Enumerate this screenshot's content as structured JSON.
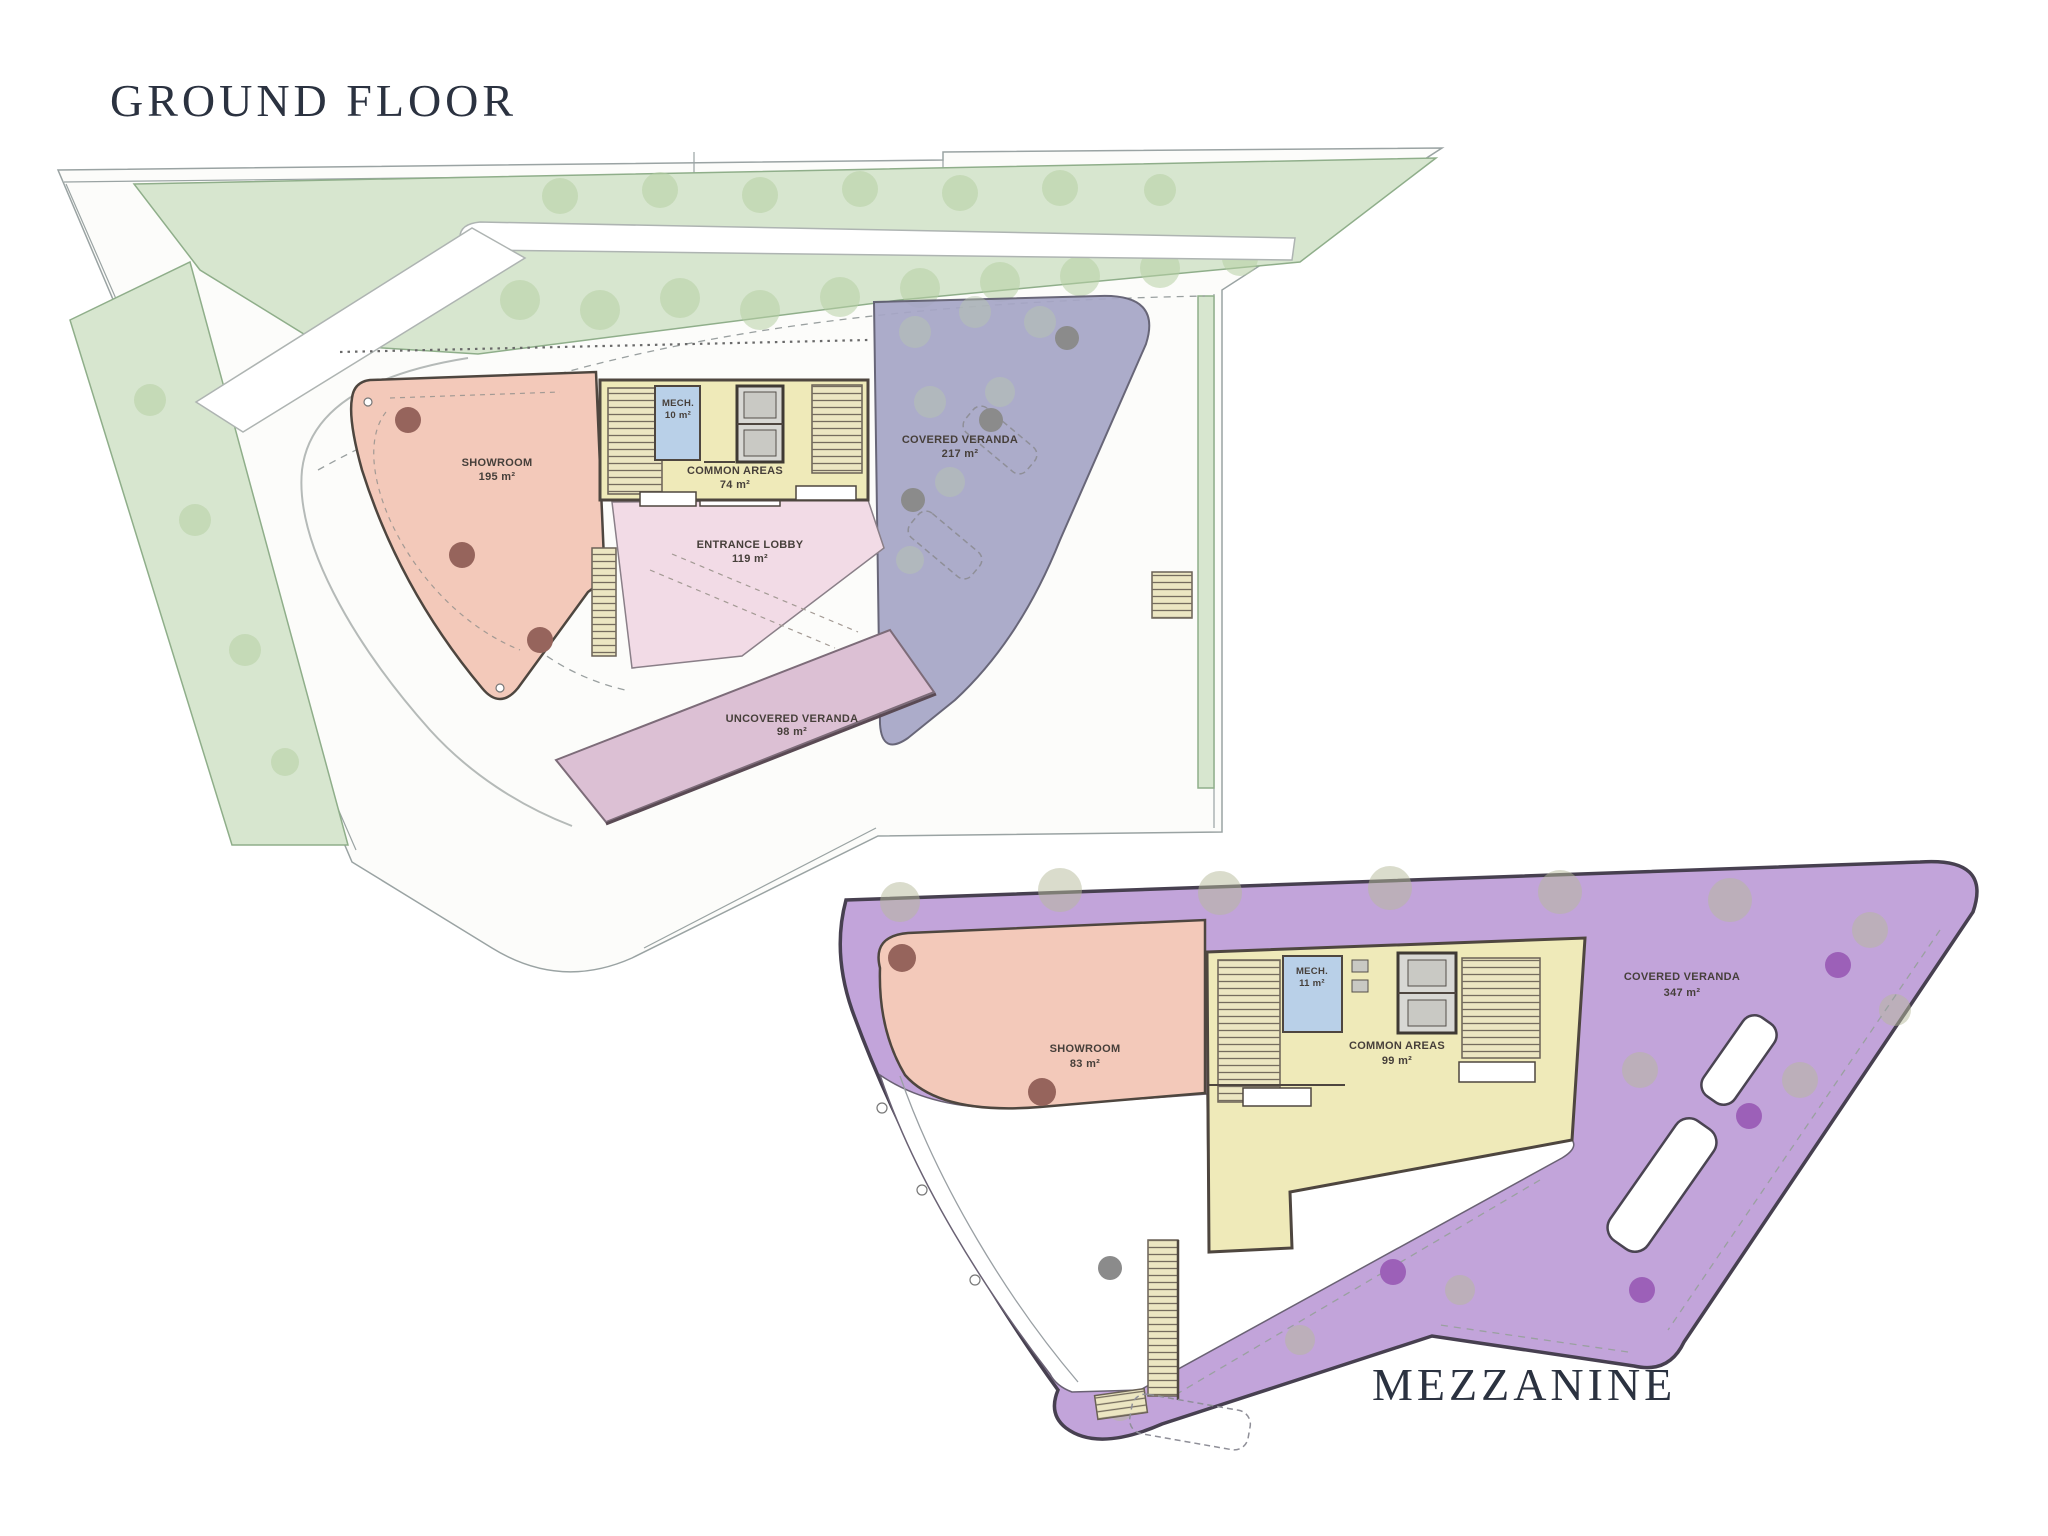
{
  "plans": [
    {
      "id": "ground-floor",
      "title": "GROUND FLOOR",
      "rooms": [
        {
          "name": "SHOWROOM",
          "area": "195 m²"
        },
        {
          "name": "MECH.",
          "area": "10 m²"
        },
        {
          "name": "COMMON AREAS",
          "area": "74 m²"
        },
        {
          "name": "ENTRANCE LOBBY",
          "area": "119 m²"
        },
        {
          "name": "COVERED VERANDA",
          "area": "217 m²"
        },
        {
          "name": "UNCOVERED VERANDA",
          "area": "98 m²"
        }
      ]
    },
    {
      "id": "mezzanine",
      "title": "MEZZANINE",
      "rooms": [
        {
          "name": "SHOWROOM",
          "area": "83 m²"
        },
        {
          "name": "MECH.",
          "area": "11 m²"
        },
        {
          "name": "COMMON AREAS",
          "area": "99 m²"
        },
        {
          "name": "COVERED VERANDA",
          "area": "347 m²"
        }
      ]
    }
  ],
  "colors": {
    "title_color": "#2b3240",
    "green": "#d7e6cf",
    "green_border": "#8fae8a",
    "tree": "#b7cfa4",
    "showroom": "#f3c9ba",
    "lobby": "#f2dbe6",
    "uncovered": "#dcc0d4",
    "yellow": "#efeab9",
    "mech": "#b9d0e8",
    "veranda": "#a6a6c6",
    "mezz": "#c2a4da",
    "wall": "#4e463f",
    "dot_brown": "#96645c",
    "dot_purple": "#9c60b8"
  }
}
